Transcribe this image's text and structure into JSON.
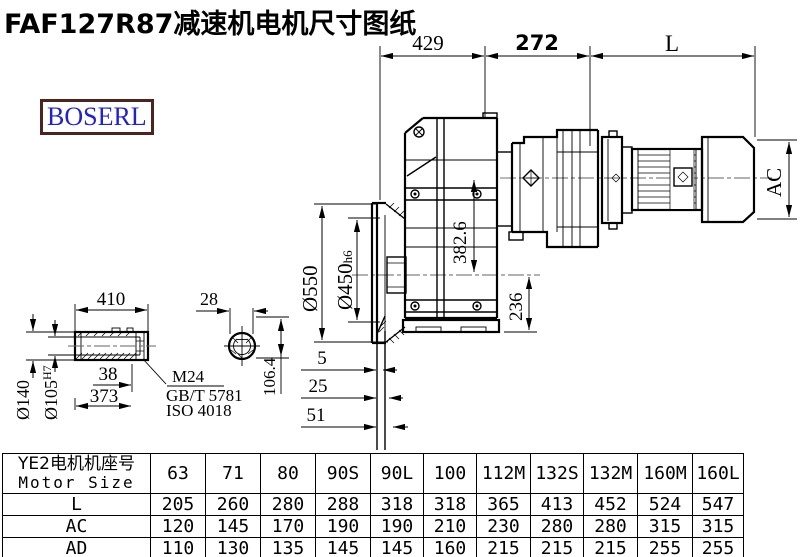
{
  "title": "FAF127R87减速机电机尺寸图纸",
  "logo": "BOSERL",
  "colors": {
    "logo_text": "#2222cc",
    "logo_border": "#4a2420",
    "line": "#000000"
  },
  "dims": {
    "top_left": "429",
    "top_mid": "272",
    "top_right": "L",
    "ac": "AC",
    "flange_od": "Ø550",
    "spigot": "Ø450",
    "spigot_tol": "h6",
    "axis_distance": "382.6",
    "center_to_base": "236",
    "off1": "5",
    "off2": "25",
    "off3": "51",
    "shaft_len": "410",
    "shaft_od": "Ø140",
    "bore": "Ø105",
    "bore_tol": "H7",
    "dim38": "38",
    "dim373": "373",
    "thread": "M24",
    "std1": "GB/T 5781",
    "std2": "ISO 4018",
    "key_w": "28",
    "key_h": "106.4"
  },
  "table": {
    "header_cn": "YE2电机机座号",
    "header_en": "Motor Size",
    "columns": [
      "63",
      "71",
      "80",
      "90S",
      "90L",
      "100",
      "112M",
      "132S",
      "132M",
      "160M",
      "160L"
    ],
    "rows": [
      {
        "label": "L",
        "values": [
          "205",
          "260",
          "280",
          "288",
          "318",
          "318",
          "365",
          "413",
          "452",
          "524",
          "547"
        ]
      },
      {
        "label": "AC",
        "values": [
          "120",
          "145",
          "170",
          "190",
          "190",
          "210",
          "230",
          "280",
          "280",
          "315",
          "315"
        ]
      },
      {
        "label": "AD",
        "values": [
          "110",
          "130",
          "135",
          "145",
          "145",
          "160",
          "215",
          "215",
          "215",
          "255",
          "255"
        ]
      }
    ]
  }
}
